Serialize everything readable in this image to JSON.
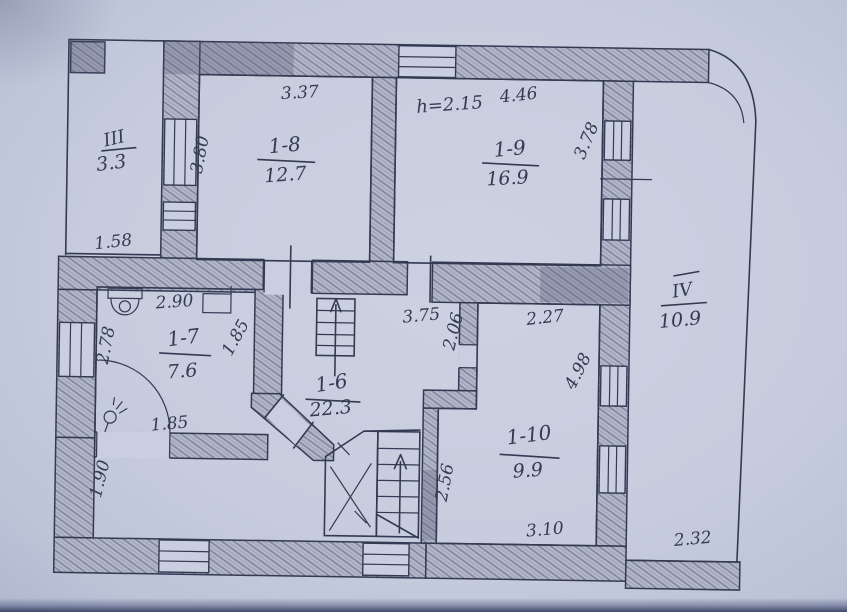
{
  "plan": {
    "type": "floor-plan-sketch",
    "colors": {
      "paper": "#c9cfe0",
      "ink": "#333a52",
      "wall_shade": "#b2b7ca",
      "wall_hatch": "#7e8398",
      "photo_edge": "#4e5878"
    },
    "rooms": {
      "hall3": {
        "number": "III",
        "area": "3.3",
        "dim_bottom": "1.58"
      },
      "r8": {
        "number": "1-8",
        "area": "12.7",
        "dim_top": "3.37",
        "dim_left": "3.80"
      },
      "r9": {
        "number": "1-9",
        "area": "16.9",
        "ceiling_note": "h=2.15",
        "dim_top": "4.46",
        "dim_right": "3.78"
      },
      "hall4": {
        "number": "IV",
        "area": "10.9",
        "dim_bottom": "2.32"
      },
      "r7": {
        "number": "1-7",
        "area": "7.6",
        "dim_top": "2.90",
        "dim_left": "2.78",
        "dim_right": "1.85",
        "dim_bottom": "1.85"
      },
      "r6": {
        "number": "1-6",
        "area": "22.3",
        "dim_top": "3.75",
        "dim_left": "1.90",
        "dim_stair": "2.56"
      },
      "r10": {
        "number": "1-10",
        "area": "9.9",
        "dim_upper_left": "2.06",
        "dim_top": "2.27",
        "dim_right": "4.98",
        "dim_bottom": "3.10"
      }
    }
  }
}
